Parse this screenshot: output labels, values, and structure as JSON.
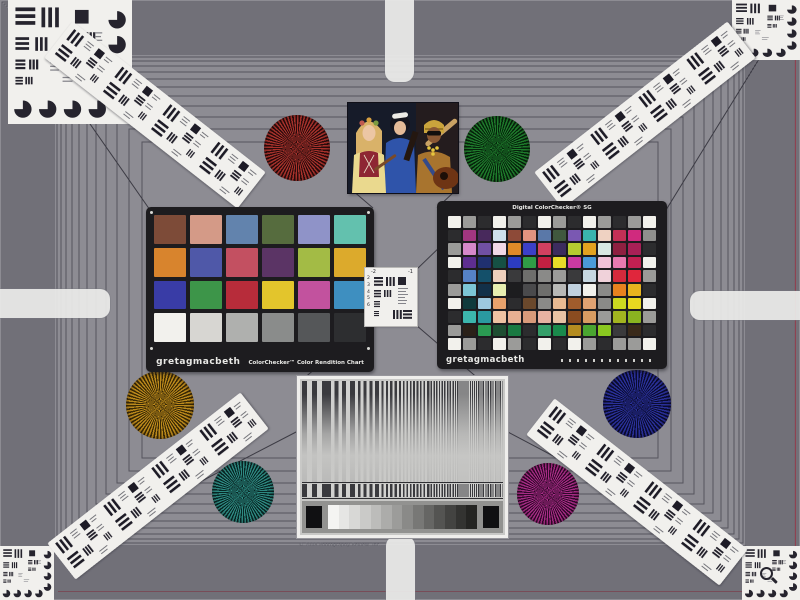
{
  "colorchecker": {
    "brand": "gretagmacbeth",
    "title": "ColorChecker™ Color Rendition Chart",
    "cols": 6,
    "patches": [
      "#7d4b38",
      "#d49a87",
      "#6283ad",
      "#566c3e",
      "#8f93c8",
      "#63c1ae",
      "#d8842d",
      "#4f58a8",
      "#c35061",
      "#5b3465",
      "#a3bb45",
      "#dcaa2c",
      "#393ca6",
      "#3d9549",
      "#b72c3a",
      "#e3c52c",
      "#c2529e",
      "#3e8fc0",
      "#f2f1ed",
      "#d7d6d2",
      "#afb0ae",
      "#8a8c8b",
      "#555759",
      "#2d2e30"
    ]
  },
  "sg": {
    "title": "Digital ColorChecker® SG",
    "brand": "gretagmacbeth",
    "cols": 14,
    "patches": [
      "#f2f1ec",
      "#9b9b99",
      "#2c2c2e",
      "#f2f1ec",
      "#9b9b99",
      "#2c2c2e",
      "#f2f1ec",
      "#9b9b99",
      "#2c2c2e",
      "#f2f1ec",
      "#9b9b99",
      "#2c2c2e",
      "#9b9b99",
      "#f2f1ec",
      "#2c2c2e",
      "#a23680",
      "#48295c",
      "#cfe0ec",
      "#8d4a38",
      "#e29480",
      "#5a78a8",
      "#40583e",
      "#7a58b2",
      "#3ab4ae",
      "#efd2c2",
      "#c23056",
      "#d02a7e",
      "#8f8f8d",
      "#9b9b99",
      "#d688ca",
      "#7050a2",
      "#f2d8e6",
      "#e08a28",
      "#3c40c8",
      "#d24060",
      "#3c2c5e",
      "#b6cc30",
      "#e2a220",
      "#d8e8e2",
      "#8e2040",
      "#a82056",
      "#2c2c2e",
      "#f2f1ec",
      "#5e2e90",
      "#203070",
      "#165044",
      "#2c3cc0",
      "#309c46",
      "#c42042",
      "#e8dc28",
      "#cc3aa2",
      "#4a9ad8",
      "#f0c2d8",
      "#e87ab0",
      "#c22052",
      "#f2f1ec",
      "#2c2c2e",
      "#5582c6",
      "#14506a",
      "#eecfbc",
      "#3a3a3c",
      "#6e6e6c",
      "#8a8a88",
      "#9b9b99",
      "#3a3a3c",
      "#c6d6e0",
      "#f0d2da",
      "#d42a3c",
      "#e0263c",
      "#9b9b99",
      "#9b9b99",
      "#7cc6d6",
      "#123048",
      "#e8eeb0",
      "#1d1d1f",
      "#4a4a4c",
      "#6e6e6c",
      "#b8b8b6",
      "#c0d0de",
      "#f2f1ec",
      "#8a8a88",
      "#e8821e",
      "#e8b41e",
      "#2c2c2e",
      "#f2f1ec",
      "#103a3c",
      "#9ec8de",
      "#e8a26c",
      "#2c2c2e",
      "#6a482c",
      "#8a8a88",
      "#e8ba92",
      "#a05c2c",
      "#e0a272",
      "#8a8a88",
      "#ccd820",
      "#e8d820",
      "#f2f1ec",
      "#2c2c2e",
      "#3cb6ac",
      "#2a9aa0",
      "#eec2a2",
      "#e8b092",
      "#d89a7a",
      "#e8b2a2",
      "#e8c2a4",
      "#8a4c20",
      "#d89c62",
      "#9b9b99",
      "#a2b420",
      "#8ab420",
      "#9b9b99",
      "#9b9b99",
      "#2a2018",
      "#2a9a52",
      "#1e4e32",
      "#1a7a42",
      "#2c2c2e",
      "#36a06a",
      "#1a8a4c",
      "#b48c20",
      "#4aa530",
      "#8ac820",
      "#3a3a3c",
      "#3a2a1a",
      "#2c2c2e",
      "#f2f1ec",
      "#9b9b99",
      "#2c2c2e",
      "#f2f1ec",
      "#9b9b99",
      "#2c2c2e",
      "#f2f1ec",
      "#2c2c2e",
      "#f2f1ec",
      "#9b9b99",
      "#2c2c2e",
      "#9b9b99",
      "#9b9b99",
      "#f2f1ec"
    ]
  },
  "stars": {
    "red": {
      "color": "#a8322c",
      "dark": "#2a0c0c"
    },
    "green": {
      "color": "#1f7c2c",
      "dark": "#06240c"
    },
    "gold": {
      "color": "#bc8a1c",
      "dark": "#3a2a06"
    },
    "navy": {
      "color": "#2a309a",
      "dark": "#0a0c30"
    },
    "teal": {
      "color": "#2e8a82",
      "dark": "#082624"
    },
    "magenta": {
      "color": "#a82c86",
      "dark": "#30082a"
    }
  },
  "center_target": {
    "top_labels": [
      "-2",
      "-1"
    ],
    "left_labels": [
      "2",
      "3",
      "4",
      "5",
      "6"
    ]
  },
  "res": {
    "periods": [
      10,
      7.6,
      5.8,
      4.4,
      3.4,
      2.7,
      2.1,
      1.7
    ],
    "dark": "#3a3a3e",
    "light": "#d2d2d0",
    "wedge": [
      "#f4f4f2",
      "#e6e6e4",
      "#d8d8d6",
      "#cacac8",
      "#bcbcba",
      "#acacaa",
      "#9c9c9a",
      "#8a8a88",
      "#787876",
      "#666664",
      "#545452",
      "#434341",
      "#333331",
      "#242422"
    ]
  },
  "frame": {
    "dense_from": 2,
    "dense_to": 54,
    "dense_step": 2,
    "sparse": [
      57,
      61,
      66,
      72,
      79,
      87,
      96,
      106,
      117,
      129,
      142
    ],
    "line_color": "#55545e"
  },
  "caption": "© 2008 Photography Review, Inc."
}
